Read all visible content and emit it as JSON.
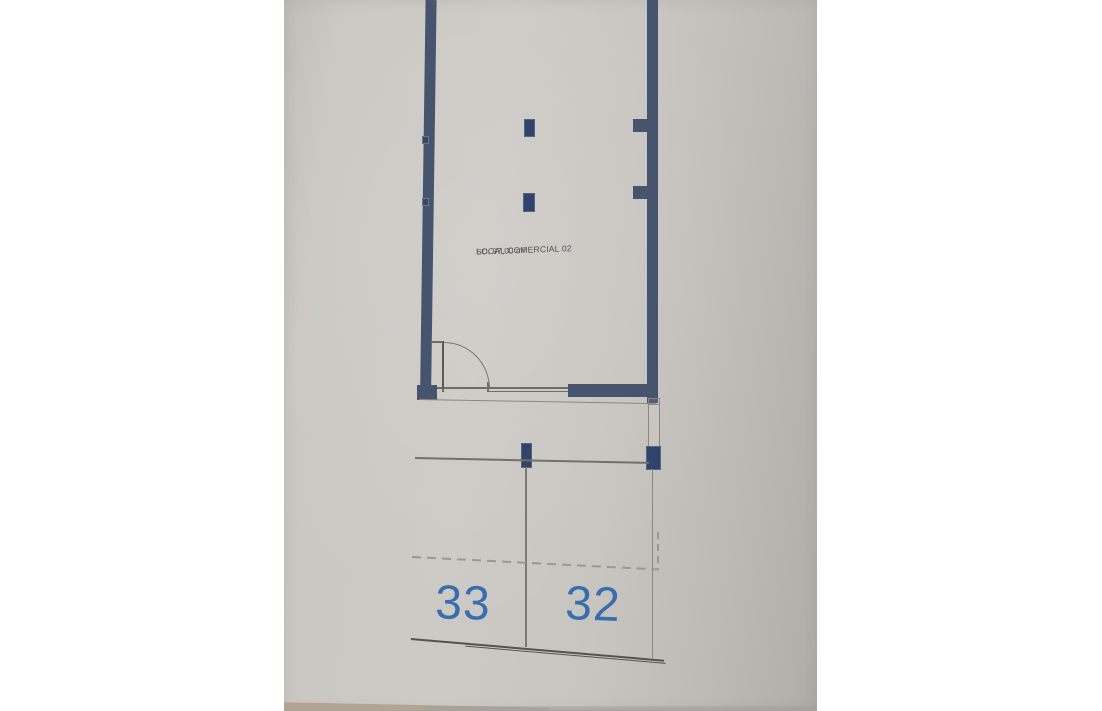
{
  "plan": {
    "room": {
      "label_line1": "LOCAL COMERCIAL 02",
      "label_line2": "SC: 97,00 m²"
    },
    "parking": {
      "space_left": "33",
      "space_right": "32"
    },
    "colors": {
      "wall_blue": "#46546e",
      "column_blue": "#30436a",
      "number_blue": "#376eaf",
      "thin_line_gray": "#6f6d68",
      "dashed_gray": "#9b9892",
      "paper_gray": "#c8c5c0",
      "margin_white": "#ffffff"
    }
  }
}
